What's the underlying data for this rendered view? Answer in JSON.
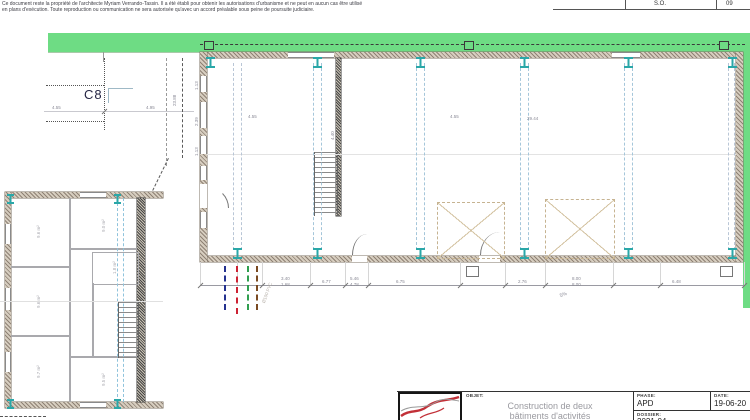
{
  "disclaimer": {
    "line1": "Ce document reste la propriété de l'architecte Myriam Verrando-Tassin. Il a été établi pour obtenir les autorisations d'urbanisme et ne peut en aucun cas être utilisé",
    "line2": "en plans d'exécution. Toute reproduction ou communication ne sera autorisée qu'avec un accord préalable sous peine de poursuite judiciaire."
  },
  "rev_table": {
    "scale": "S.O.",
    "sheet": "09"
  },
  "parcel": {
    "label": "C8",
    "dim_a": "4.55",
    "dim_b": "4.95",
    "boundary_length": "23.88"
  },
  "building": {
    "width_dim": "29.44",
    "bay_dim_left": "4.55",
    "bay_dim_right": "4.55",
    "stair_dim": "4.40",
    "left_wall_dims": [
      "1.13",
      "2.39",
      "1.13"
    ],
    "bottom_dims": [
      "3.40",
      "1.68",
      "6.77",
      "5.46",
      "4.78",
      "6.75",
      "2.76",
      "8.00",
      "8.00",
      "6.48"
    ],
    "slope": "5%",
    "utility_label": "Ø100 PVC"
  },
  "annex": {
    "rooms": [
      "9.6 m²",
      "9.6 m²",
      "9.7 m²",
      "9.0 m²",
      "1.8 m²",
      "9.5 m²"
    ]
  },
  "titleblock": {
    "objet_label": "OBJET:",
    "objet_line1": "Construction de deux",
    "objet_line2": "bâtiments d'activités",
    "phase_label": "PHASE:",
    "phase_value": "APD",
    "date_label": "DATE:",
    "date_value": "19-06-20",
    "dossier_label": "DOSSIER:",
    "dossier_value": "2021-04"
  },
  "colors": {
    "grass": "#6edc84",
    "column": "#2aa7a8",
    "wall": "#9b8f80",
    "utility_blue": "#24318f",
    "utility_red": "#cc2233",
    "utility_green": "#2f9e4f",
    "utility_brown": "#7a4a22"
  }
}
